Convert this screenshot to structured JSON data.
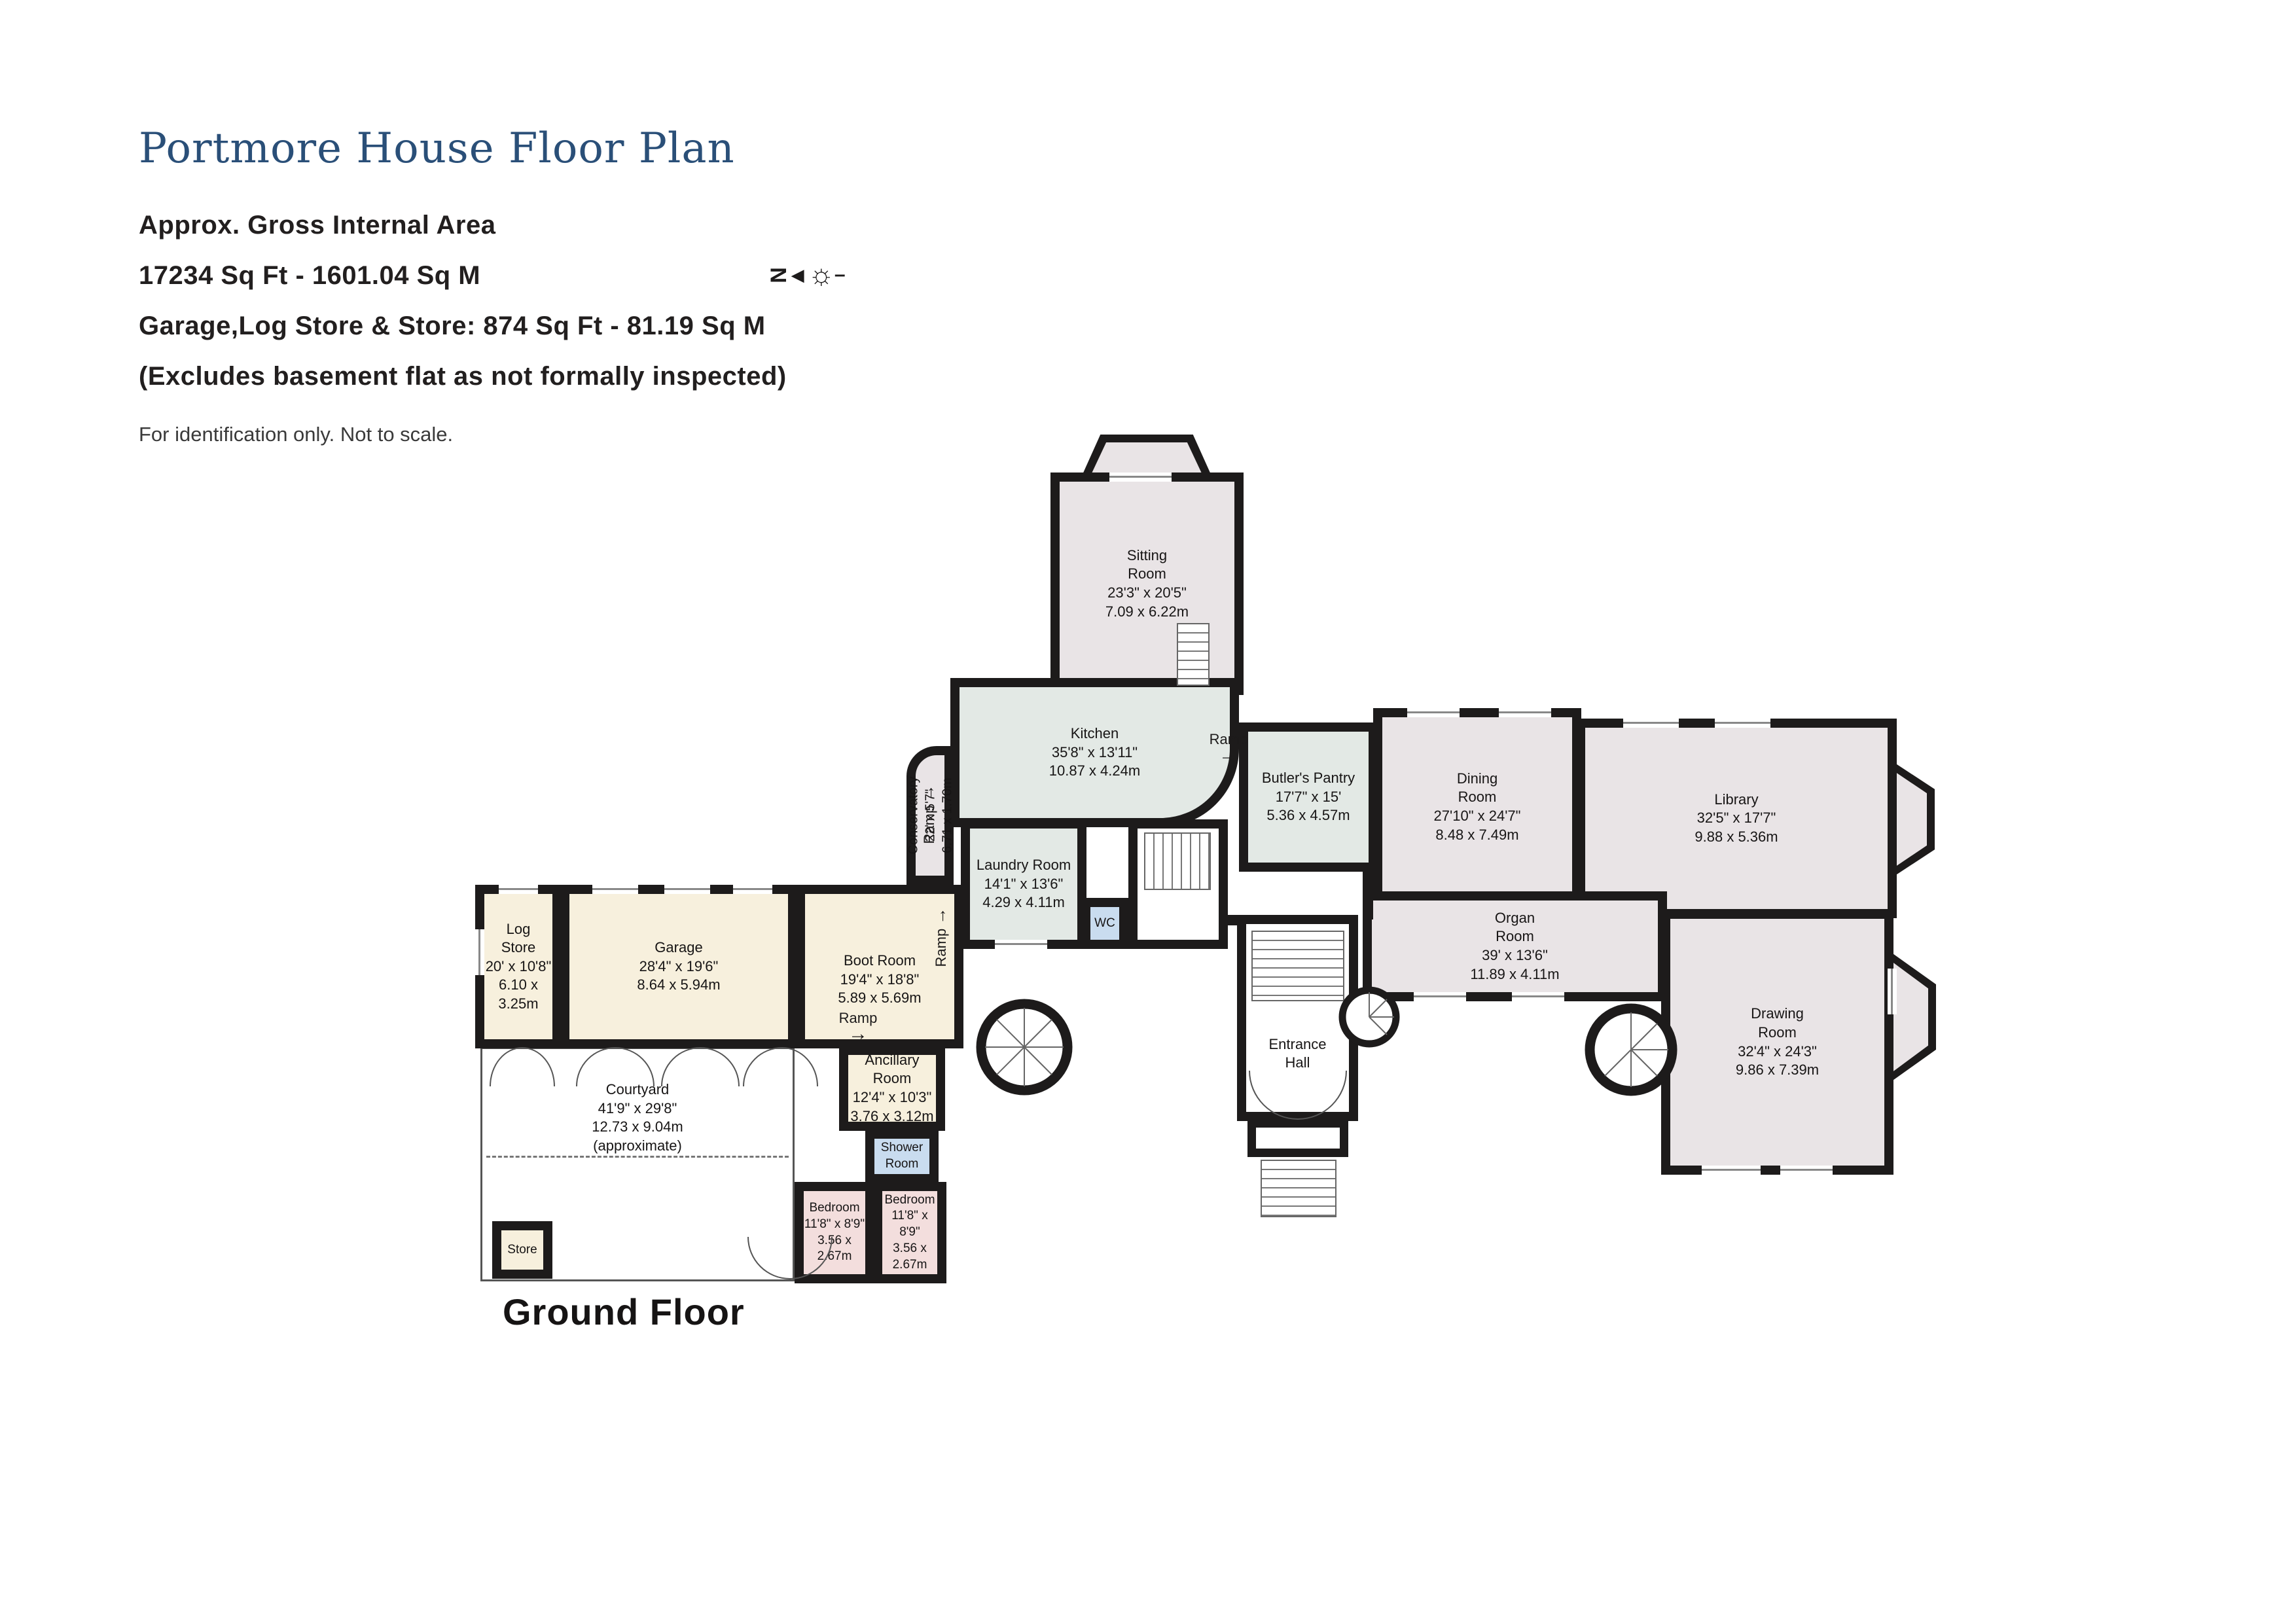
{
  "header": {
    "title": "Portmore House Floor Plan",
    "line1": "Approx. Gross Internal Area",
    "line2": "17234 Sq Ft - 1601.04 Sq M",
    "line3": "Garage,Log Store & Store: 874 Sq Ft - 81.19 Sq M",
    "line4": "(Excludes basement flat as not formally inspected)",
    "disclaimer": "For identification only. Not to scale."
  },
  "compass": {
    "letter": "N",
    "arrow": "◀",
    "sun": "☼",
    "dash": "–"
  },
  "floor_label": "Ground Floor",
  "colors": {
    "wall": "#1d1b1b",
    "title_blue": "#2a4f78",
    "room_pink": "#e9e4e6",
    "room_green": "#e3e9e5",
    "room_cream": "#f7f0dd",
    "room_bedpink": "#f3dedd",
    "room_blue": "#c9dcef"
  },
  "rooms": [
    {
      "id": "sitting",
      "name": "Sitting\nRoom",
      "dim_ft": "23'3\" x 20'5\"",
      "dim_m": "7.09 x 6.22m"
    },
    {
      "id": "kitchen",
      "name": "Kitchen",
      "dim_ft": "35'8\" x 13'11\"",
      "dim_m": "10.87 x 4.24m"
    },
    {
      "id": "conservatory",
      "name": "Conservatory",
      "dim_ft": "22' x 5'7\"",
      "dim_m": "6.71 x 1.70m"
    },
    {
      "id": "laundry",
      "name": "Laundry Room",
      "dim_ft": "14'1\" x 13'6\"",
      "dim_m": "4.29 x 4.11m"
    },
    {
      "id": "wc",
      "name": "WC"
    },
    {
      "id": "butlers",
      "name": "Butler's Pantry",
      "dim_ft": "17'7\" x 15'",
      "dim_m": "5.36 x 4.57m"
    },
    {
      "id": "dining",
      "name": "Dining\nRoom",
      "dim_ft": "27'10\" x 24'7\"",
      "dim_m": "8.48 x 7.49m"
    },
    {
      "id": "library",
      "name": "Library",
      "dim_ft": "32'5\" x 17'7\"",
      "dim_m": "9.88 x 5.36m"
    },
    {
      "id": "organ",
      "name": "Organ\nRoom",
      "dim_ft": "39' x 13'6\"",
      "dim_m": "11.89 x 4.11m"
    },
    {
      "id": "drawing",
      "name": "Drawing\nRoom",
      "dim_ft": "32'4\" x 24'3\"",
      "dim_m": "9.86 x 7.39m"
    },
    {
      "id": "entrance",
      "name": "Entrance\nHall"
    },
    {
      "id": "logstore",
      "name": "Log\nStore",
      "dim_ft": "20' x 10'8\"",
      "dim_m": "6.10 x 3.25m"
    },
    {
      "id": "garage",
      "name": "Garage",
      "dim_ft": "28'4\" x 19'6\"",
      "dim_m": "8.64 x 5.94m"
    },
    {
      "id": "bootroom",
      "name": "Boot Room",
      "dim_ft": "19'4\" x 18'8\"",
      "dim_m": "5.89 x 5.69m"
    },
    {
      "id": "ancillary",
      "name": "Ancillary\nRoom",
      "dim_ft": "12'4\" x 10'3\"",
      "dim_m": "3.76 x 3.12m"
    },
    {
      "id": "shower",
      "name": "Shower\nRoom"
    },
    {
      "id": "bedroom_left",
      "name": "Bedroom",
      "dim_ft": "11'8\" x 8'9\"",
      "dim_m": "3.56 x 2.67m"
    },
    {
      "id": "bedroom_right",
      "name": "Bedroom",
      "dim_ft": "11'8\" x 8'9\"",
      "dim_m": "3.56 x 2.67m"
    },
    {
      "id": "courtyard",
      "name": "Courtyard",
      "dim_ft": "41'9\" x 29'8\"",
      "dim_m": "12.73 x 9.04m",
      "extra": "(approximate)"
    },
    {
      "id": "store",
      "name": "Store"
    }
  ],
  "ramps": [
    {
      "label": "Ramp",
      "arrow": "→"
    },
    {
      "label": "Ramp",
      "arrow": "→"
    },
    {
      "label": "Ramp",
      "arrow": "→"
    },
    {
      "label": "Ramp",
      "arrow": "→"
    }
  ]
}
